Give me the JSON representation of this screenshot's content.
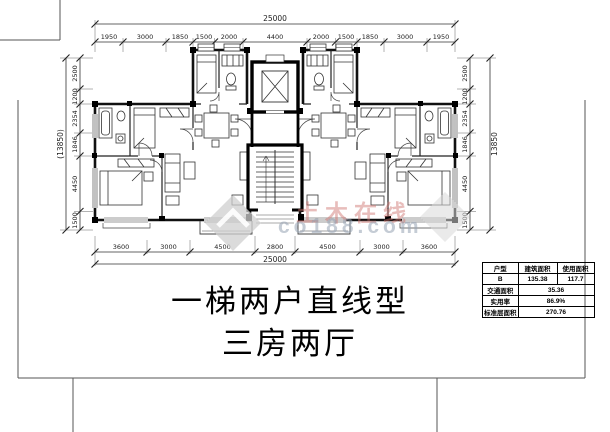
{
  "title": {
    "line1": "一梯两户直线型",
    "line2": "三房两厅"
  },
  "watermark": {
    "brand_cn": "土木在线",
    "brand_url": "co188.com"
  },
  "dims": {
    "top_total": "25000",
    "bottom_total": "25000",
    "left_total": "(13850)",
    "right_total": "13850",
    "top": [
      "1950",
      "3000",
      "1850",
      "1500",
      "2000",
      "4400",
      "2000",
      "1500",
      "1850",
      "3000",
      "1950"
    ],
    "bottom": [
      "3600",
      "3000",
      "4500",
      "2800",
      "4500",
      "3000",
      "3600"
    ],
    "left": [
      "2500",
      "1200",
      "2354",
      "1846",
      "4450",
      "1500"
    ],
    "right": [
      "2500",
      "1200",
      "2354",
      "1846",
      "4450",
      "1500"
    ]
  },
  "table": {
    "headers": [
      "户型",
      "建筑面积",
      "使用面积"
    ],
    "unit_type": "B",
    "build_area": "135.38",
    "use_area": "117.7",
    "rows": [
      {
        "label": "交通面积",
        "value": "35.36"
      },
      {
        "label": "实用率",
        "value": "86.9%"
      },
      {
        "label": "标准层面积",
        "value": "270.76"
      }
    ]
  }
}
